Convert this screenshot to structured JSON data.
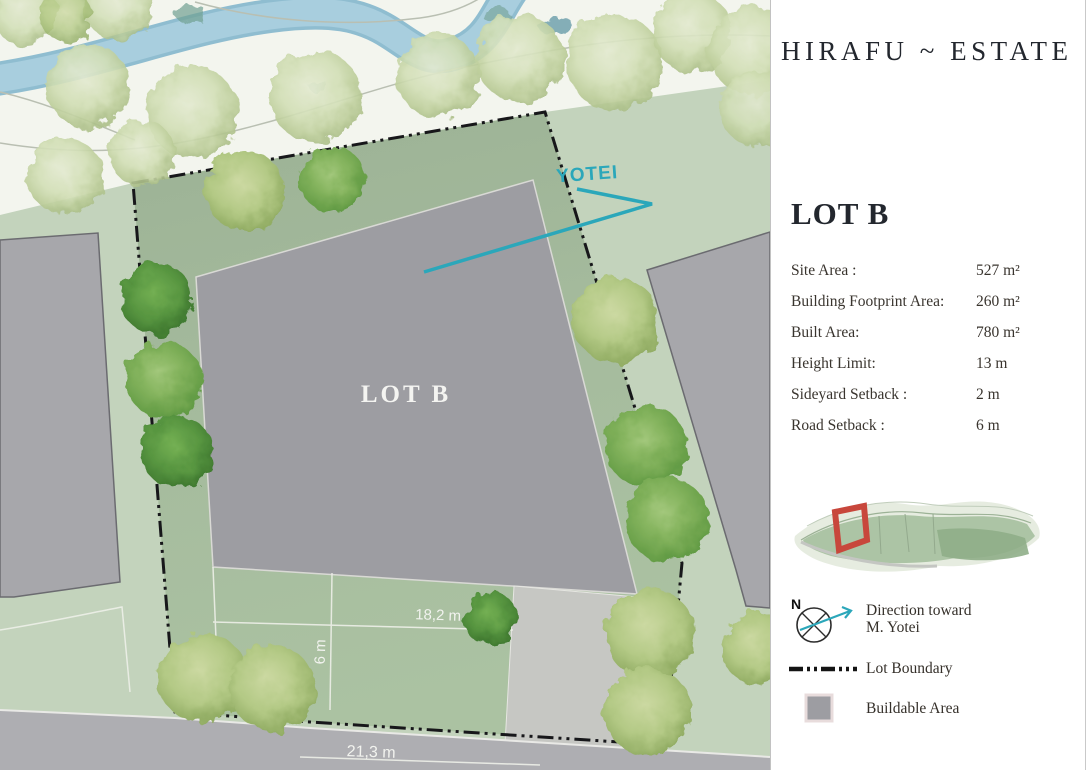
{
  "header": {
    "title": "HIRAFU ~ ESTATE"
  },
  "panel": {
    "lot_heading": "LOT B",
    "specs": [
      {
        "label": "Site Area :",
        "value": "527 m²"
      },
      {
        "label": "Building Footprint Area:",
        "value": "260 m²"
      },
      {
        "label": "Built Area:",
        "value": "780 m²"
      },
      {
        "label": "Height Limit:",
        "value": "13 m"
      },
      {
        "label": "Sideyard Setback :",
        "value": "2 m"
      },
      {
        "label": "Road Setback :",
        "value": "6 m"
      }
    ],
    "legend": {
      "north_label": "N",
      "direction_line1": "Direction toward",
      "direction_line2": "M. Yotei",
      "lot_boundary": "Lot Boundary",
      "buildable_area": "Buildable Area"
    }
  },
  "map": {
    "lot_label": "LOT B",
    "mountain_label": "YOTEI",
    "dim_top_width": "18,2 m",
    "dim_setback": "6 m",
    "dim_frontage": "21,3 m"
  },
  "colors": {
    "accent_teal": "#2ba7ba",
    "minimap_highlight": "#c8473c",
    "buildable_gray": "#9d9da2"
  }
}
